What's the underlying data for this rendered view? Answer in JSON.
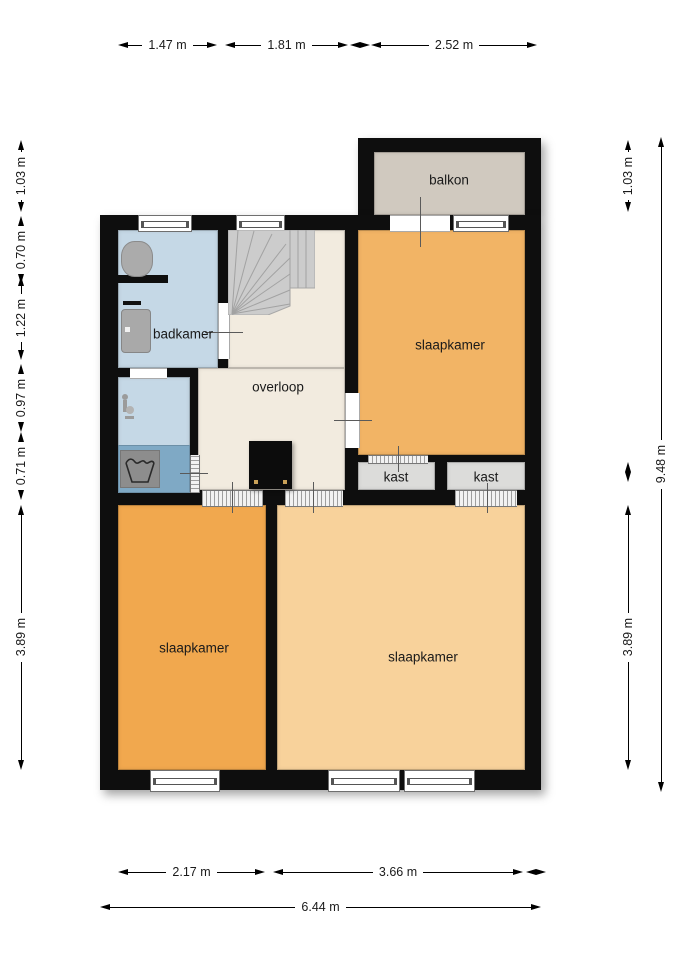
{
  "plan": {
    "rooms": {
      "balkon": "balkon",
      "badkamer": "badkamer",
      "overloop": "overloop",
      "slaapkamer_top": "slaapkamer",
      "kast_left": "kast",
      "kast_right": "kast",
      "slaapkamer_bottom_left": "slaapkamer",
      "slaapkamer_bottom_right": "slaapkamer"
    },
    "dimensions": {
      "top": [
        "1.47 m",
        "1.81 m",
        "2.52 m"
      ],
      "bottom_segments": [
        "2.17 m",
        "3.66 m"
      ],
      "bottom_total": "6.44 m",
      "left": [
        "1.03 m",
        "0.70 m",
        "1.22 m",
        "0.97 m",
        "0.71 m",
        "3.89 m"
      ],
      "right_segments": [
        "1.03 m",
        "3.89 m"
      ],
      "right_total": "9.48 m"
    },
    "colors": {
      "wall": "#0e0e0e",
      "balkon": "#d0c9bf",
      "badkamer": "#c5d8e6",
      "shower_floor": "#7fa9c5",
      "overloop": "#f2ebdf",
      "slaapkamer_top": "#f2b465",
      "slaapkamer_bottom_left": "#f1a84e",
      "slaapkamer_bottom_right": "#f8d29b",
      "kast": "#dcdcda",
      "stairs": "#cccccc"
    },
    "icons": [
      "stairs-icon",
      "toilet-icon",
      "sink-icon",
      "shower-tap-icon",
      "washing-machine-icon",
      "chimney-icon"
    ]
  }
}
